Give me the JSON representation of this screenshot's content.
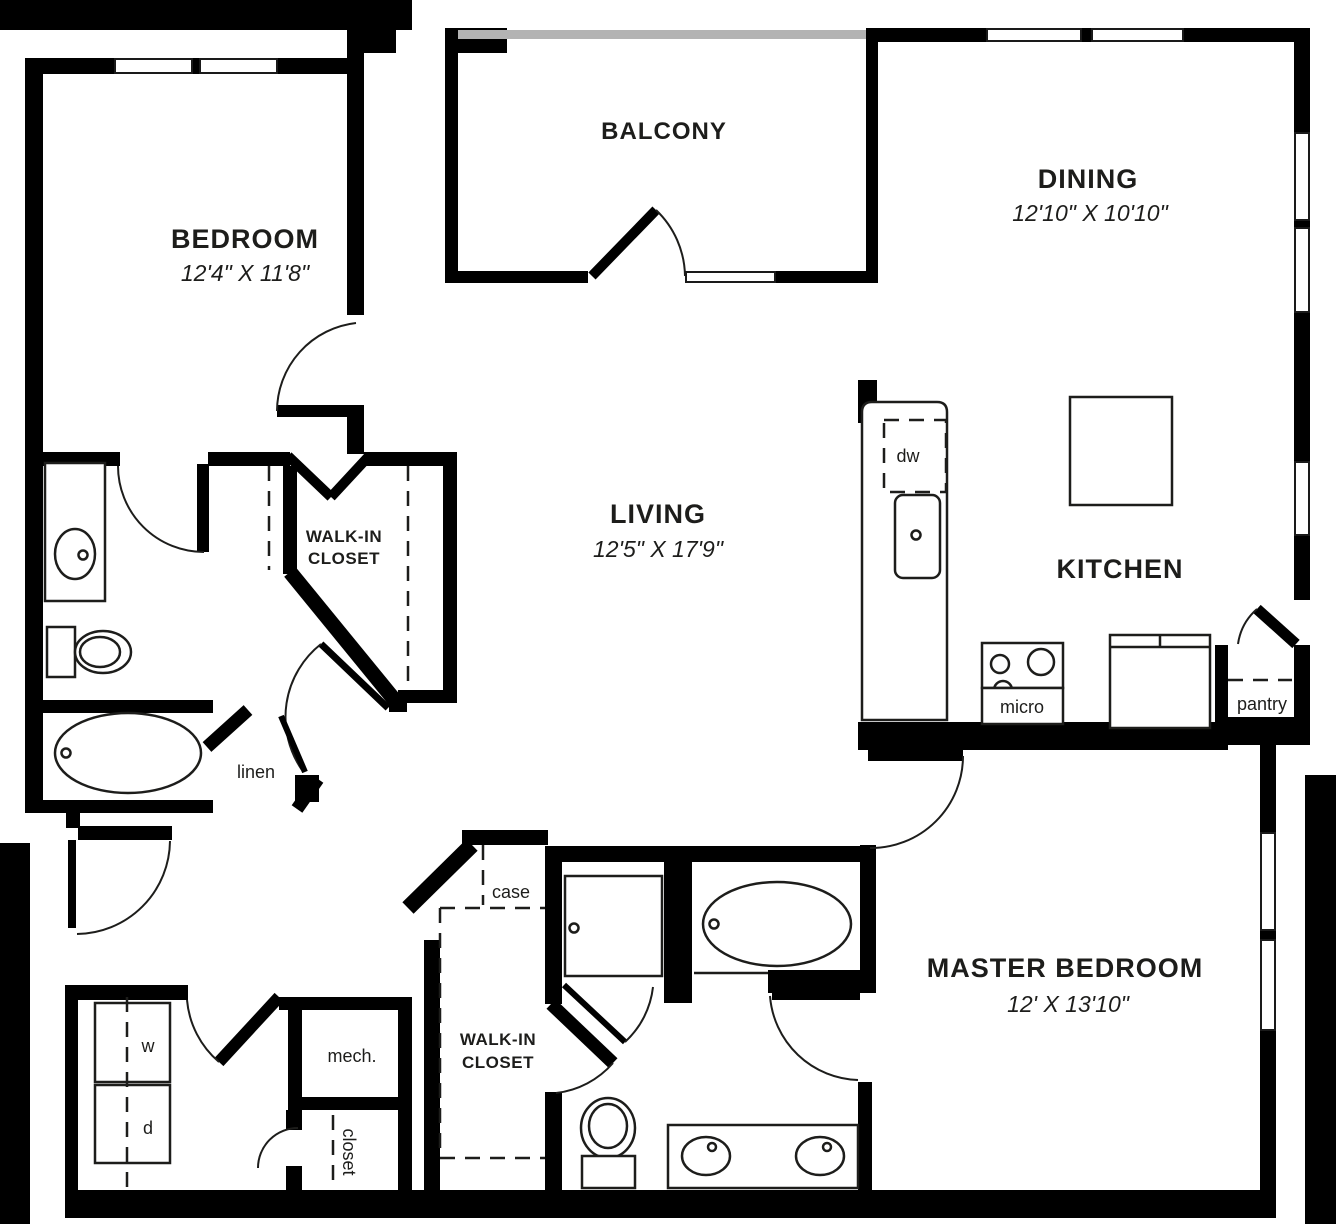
{
  "plan": {
    "colors": {
      "wall": "#000000",
      "railing": "#b3b3b3",
      "text": "#1d1d1b",
      "line": "#1d1d1b"
    },
    "rooms": {
      "bedroom": {
        "name": "BEDROOM",
        "dims": "12'4\" X 11'8\""
      },
      "balcony": {
        "name": "BALCONY"
      },
      "dining": {
        "name": "DINING",
        "dims": "12'10\" X 10'10\""
      },
      "living": {
        "name": "LIVING",
        "dims": "12'5\" X 17'9\""
      },
      "kitchen": {
        "name": "KITCHEN"
      },
      "master_bedroom": {
        "name": "MASTER BEDROOM",
        "dims": "12' X 13'10\""
      },
      "closet1": {
        "line1": "WALK-IN",
        "line2": "CLOSET"
      },
      "closet2": {
        "line1": "WALK-IN",
        "line2": "CLOSET"
      }
    },
    "labels": {
      "dw": "dw",
      "micro": "micro",
      "pantry": "pantry",
      "linen": "linen",
      "mech": "mech.",
      "closet": "closet",
      "case": "case",
      "washer": "w",
      "dryer": "d"
    }
  }
}
